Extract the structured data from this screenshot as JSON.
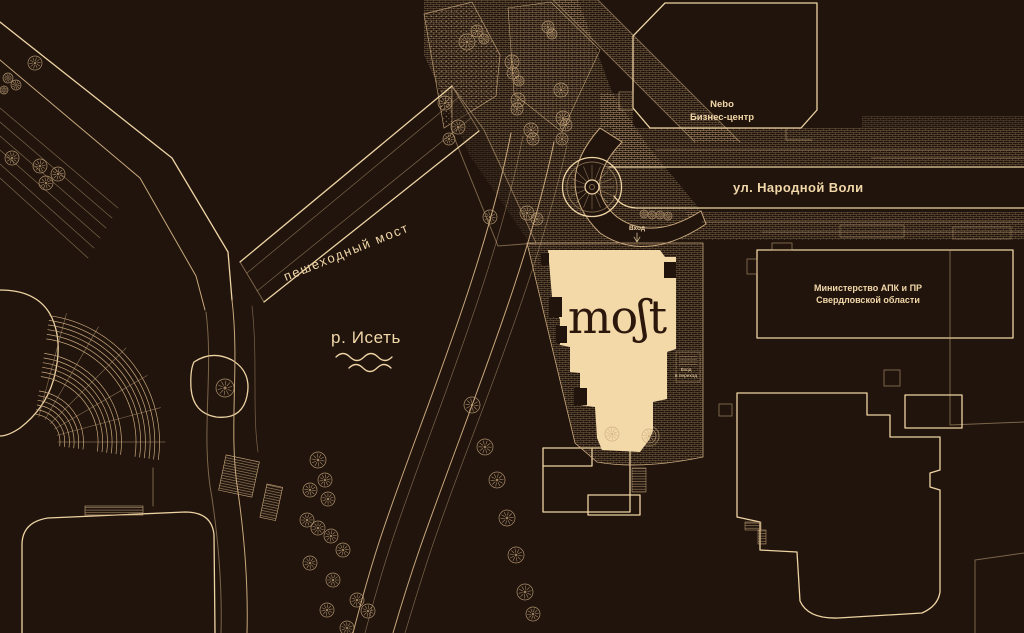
{
  "colors": {
    "background": "#20140d",
    "line": "#c9a87c",
    "line_bright": "#eed3a3",
    "building_fill": "#f3d8a8",
    "logo_text": "#2b170c",
    "label": "#f2d7a8"
  },
  "labels": {
    "logo": "moʃt",
    "nebo_line1": "Nebo",
    "nebo_line2": "Бизнес-центр",
    "street": "ул. Народной Воли",
    "bridge": "пешеходный мост",
    "river": "р. Исеть",
    "ministry_line1": "Министерство АПК и ПР",
    "ministry_line2": "Свердловской области",
    "entrance": "Вход",
    "entrance_arrow": "↓",
    "passage_line1": "Вход",
    "passage_line2": "в переход"
  },
  "trees": [
    [
      35,
      63,
      7
    ],
    [
      8,
      78,
      5
    ],
    [
      16,
      85,
      5
    ],
    [
      4,
      90,
      4
    ],
    [
      12,
      158,
      7
    ],
    [
      40,
      166,
      7
    ],
    [
      58,
      174,
      7
    ],
    [
      46,
      183,
      7
    ],
    [
      467,
      42,
      8
    ],
    [
      477,
      31,
      6
    ],
    [
      484,
      39,
      5
    ],
    [
      445,
      103,
      7
    ],
    [
      458,
      127,
      7
    ],
    [
      449,
      139,
      6
    ],
    [
      512,
      62,
      7
    ],
    [
      513,
      73,
      6
    ],
    [
      519,
      81,
      5
    ],
    [
      518,
      100,
      7
    ],
    [
      517,
      109,
      6
    ],
    [
      531,
      130,
      7
    ],
    [
      533,
      139,
      6
    ],
    [
      548,
      27,
      6
    ],
    [
      552,
      34,
      5
    ],
    [
      561,
      90,
      7
    ],
    [
      563,
      118,
      7
    ],
    [
      566,
      125,
      6
    ],
    [
      562,
      139,
      6
    ],
    [
      490,
      217,
      7
    ],
    [
      527,
      213,
      7
    ],
    [
      537,
      219,
      6
    ],
    [
      644,
      214,
      4
    ],
    [
      652,
      215,
      4
    ],
    [
      660,
      215,
      4
    ],
    [
      668,
      216,
      4
    ],
    [
      472,
      405,
      8
    ],
    [
      485,
      447,
      8
    ],
    [
      497,
      480,
      8
    ],
    [
      507,
      518,
      8
    ],
    [
      516,
      555,
      8
    ],
    [
      525,
      592,
      8
    ],
    [
      533,
      614,
      7
    ],
    [
      318,
      460,
      8
    ],
    [
      325,
      480,
      7
    ],
    [
      310,
      490,
      7
    ],
    [
      328,
      499,
      7
    ],
    [
      307,
      520,
      7
    ],
    [
      318,
      528,
      7
    ],
    [
      331,
      536,
      7
    ],
    [
      343,
      550,
      7
    ],
    [
      310,
      563,
      7
    ],
    [
      333,
      580,
      7
    ],
    [
      357,
      600,
      7
    ],
    [
      327,
      610,
      7
    ],
    [
      368,
      611,
      7
    ],
    [
      347,
      628,
      7
    ],
    [
      225,
      388,
      9
    ],
    [
      612,
      434,
      7
    ],
    [
      649,
      436,
      7
    ]
  ]
}
